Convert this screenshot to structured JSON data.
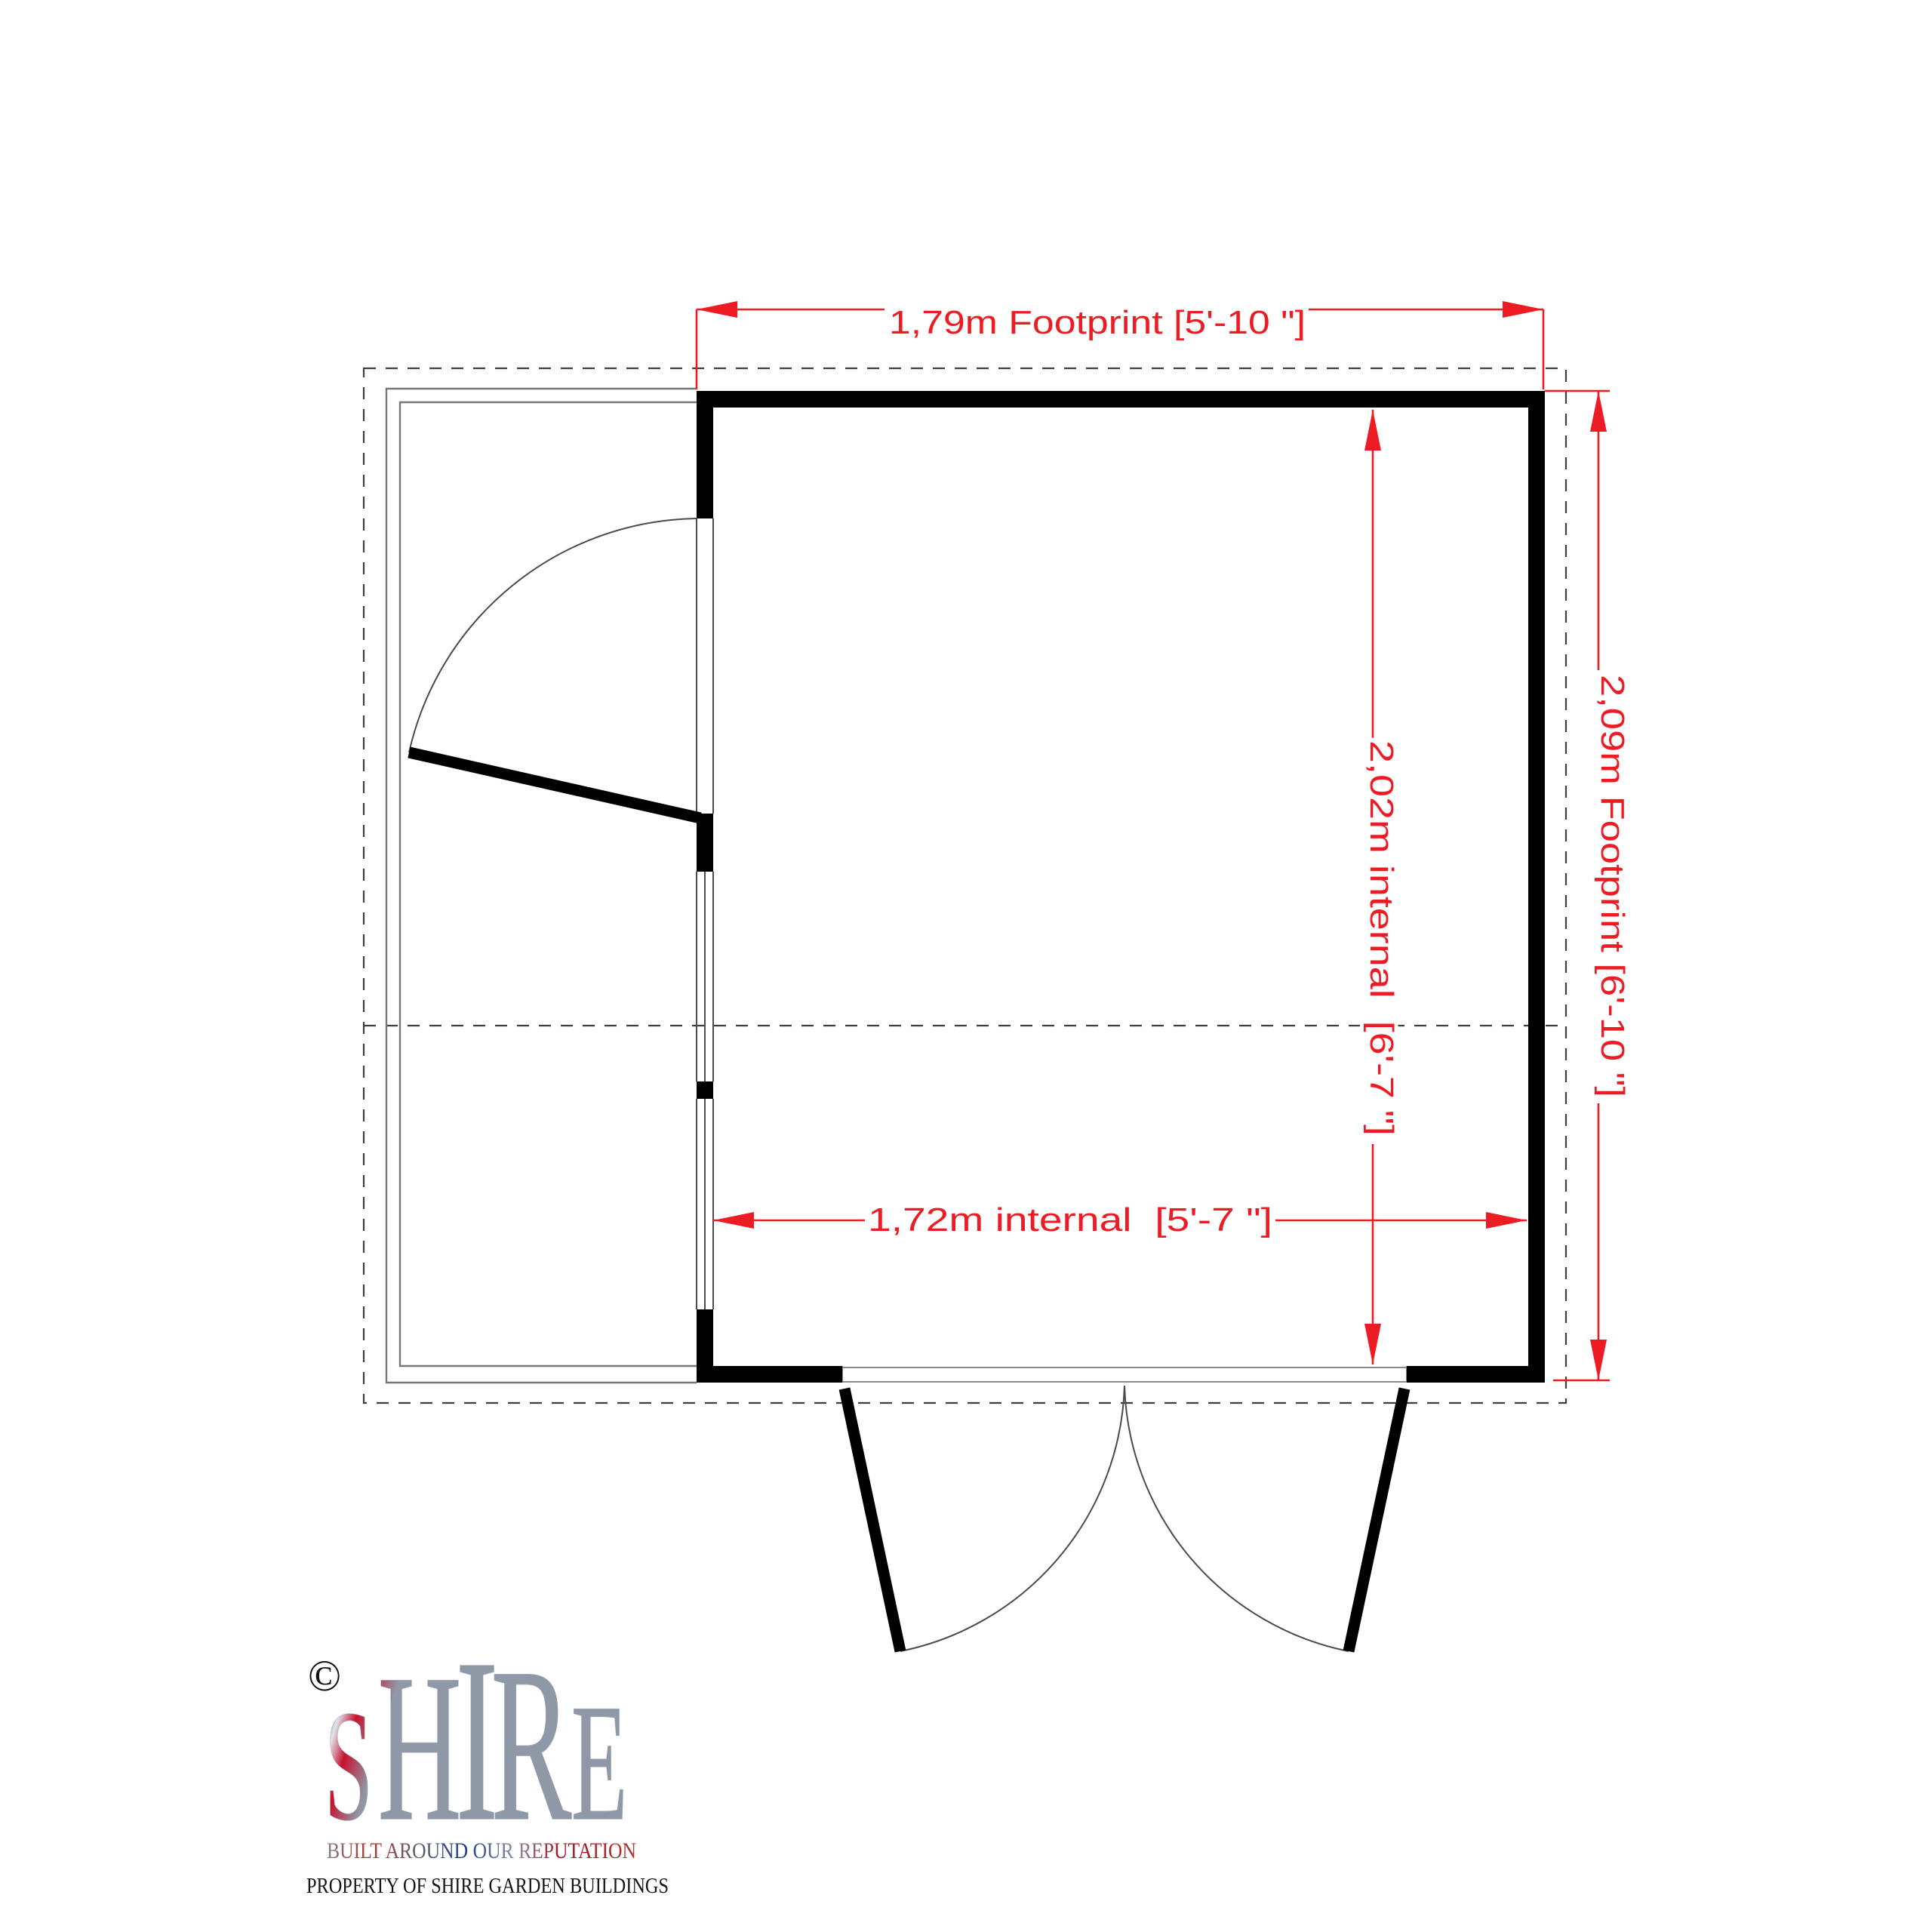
{
  "drawing": {
    "dimensions": {
      "footprint_width": {
        "label": "1,79m Footprint [5'-10 \"]"
      },
      "footprint_depth": {
        "label": "2,09m Footprint [6'-10 \"]"
      },
      "internal_depth": {
        "label": "2,02m internal  [6'-7 \"]"
      },
      "internal_width": {
        "label": "1,72m internal  [5'-7 \"]"
      }
    },
    "colors": {
      "dimension_red": "#ed1c24",
      "wall_black": "#000000",
      "thin_line_gray": "#777777",
      "window_line_gray": "#4d4d4d",
      "dash_gray": "#3f3f3f"
    }
  },
  "branding": {
    "copyright_symbol": "©",
    "logo_letters": [
      {
        "char": "S"
      },
      {
        "char": "H"
      },
      {
        "char": "I"
      },
      {
        "char": "R"
      },
      {
        "char": "E"
      }
    ],
    "tagline": "BUILT AROUND OUR REPUTATION",
    "property_notice": "PROPERTY OF SHIRE GARDEN BUILDINGS",
    "logo_colors": {
      "red": "#c8102e",
      "blue": "#1b3d91",
      "silver": "#e4e8ee"
    }
  }
}
